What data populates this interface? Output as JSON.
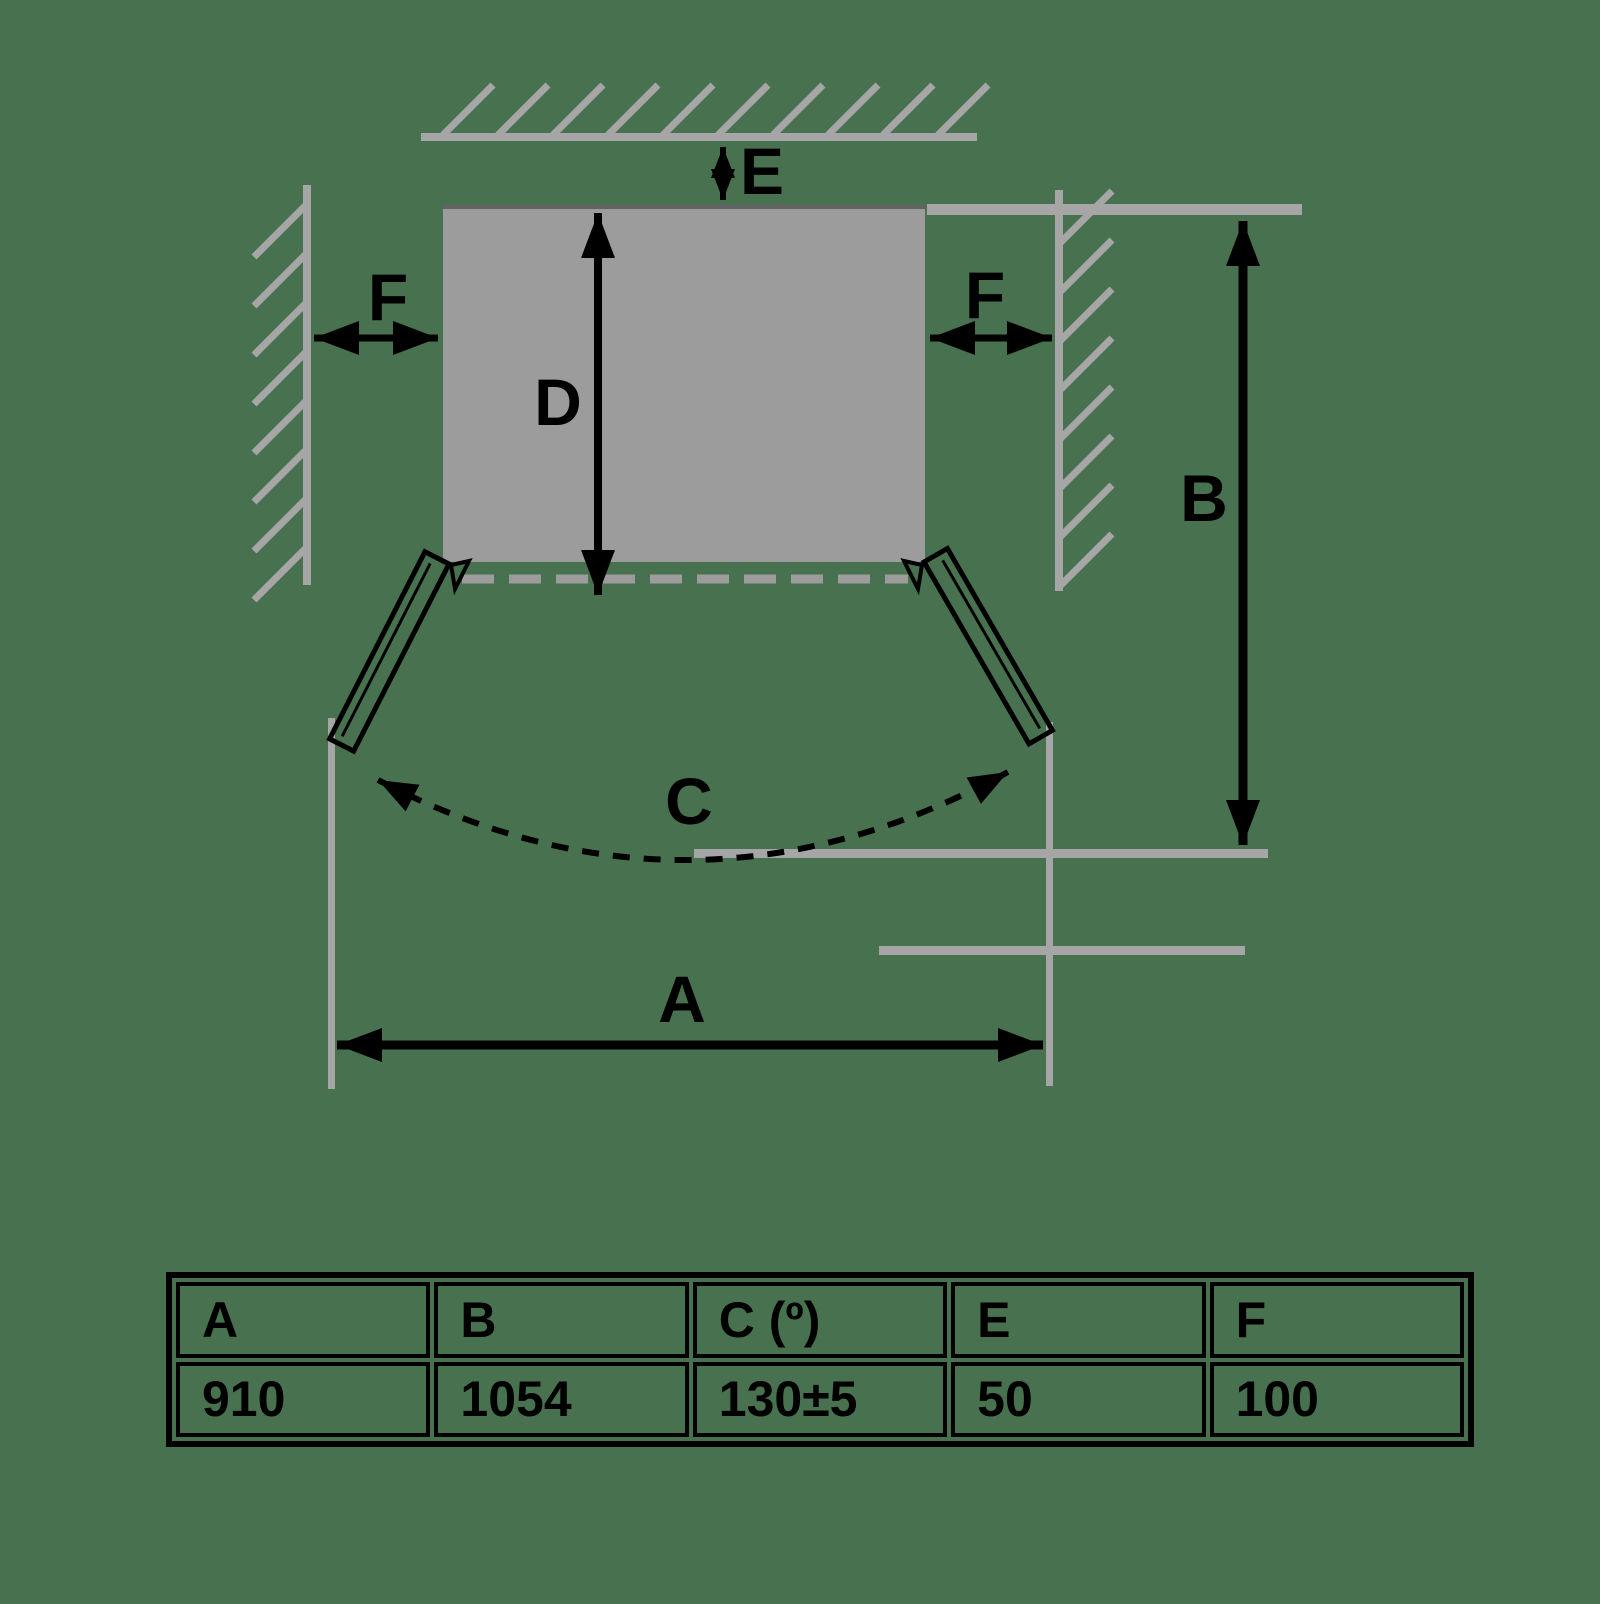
{
  "background": {
    "color": "#48724F"
  },
  "diagram": {
    "description": "Top-view installation clearance diagram of a two-door appliance with walls, open door swing and dimension arrows",
    "dimension_labels": {
      "A": "A",
      "B": "B",
      "C": "C",
      "D": "D",
      "E": "E",
      "F_left": "F",
      "F_right": "F"
    },
    "colors": {
      "wall_gray": "#a6a6a6",
      "fridge_gray": "#9c9c9c",
      "fridge_edge_dark": "#636363",
      "dimension_black": "#000000"
    }
  },
  "chart_data": {
    "type": "table",
    "title": "Installation clearance dimensions",
    "categories": [
      "A",
      "B",
      "C (º)",
      "E",
      "F"
    ],
    "values": [
      "910",
      "1054",
      "130±5",
      "50",
      "100"
    ]
  },
  "table": {
    "headers": [
      "A",
      "B",
      "C (º)",
      "E",
      "F"
    ],
    "values": [
      "910",
      "1054",
      "130±5",
      "50",
      "100"
    ]
  }
}
